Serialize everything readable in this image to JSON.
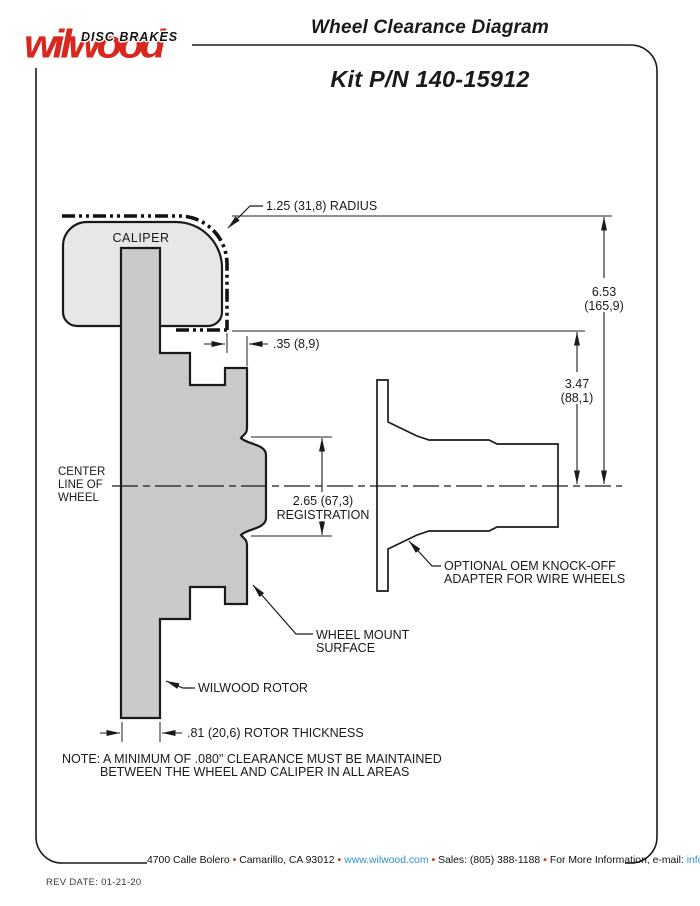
{
  "header": {
    "tagline": "DISC BRAKES",
    "brand": "wilwood",
    "title": "Wheel Clearance Diagram",
    "kit": "Kit P/N 140-15912"
  },
  "diagram": {
    "caliper": "CALIPER",
    "radius": "1.25 (31,8) RADIUS",
    "offset": ".35 (8,9)",
    "height_in": "6.53",
    "height_mm": "(165,9)",
    "hub_in": "3.47",
    "hub_mm": "(88,1)",
    "cl1": "CENTER",
    "cl2": "LINE OF",
    "cl3": "WHEEL",
    "reg_value": "2.65 (67,3)",
    "reg_label": "REGISTRATION",
    "adapter1": "OPTIONAL OEM KNOCK-OFF",
    "adapter2": "ADAPTER FOR WIRE WHEELS",
    "mount1": "WHEEL MOUNT",
    "mount2": "SURFACE",
    "rotor": "WILWOOD ROTOR",
    "thickness": ".81 (20,6) ROTOR THICKNESS",
    "note1": "NOTE: A MINIMUM OF .080\" CLEARANCE MUST BE MAINTAINED",
    "note2": "BETWEEN THE WHEEL AND CALIPER IN ALL AREAS"
  },
  "footer": {
    "address": "4700 Calle Bolero",
    "city": "Camarillo, CA 93012",
    "web": "www.wilwood.com",
    "sales": "Sales: (805) 388-1188",
    "more": "For More Information, e-mail:",
    "email": "info@wilwood.com",
    "sep": "•",
    "rev": "REV DATE:  01-21-20"
  },
  "colors": {
    "brand_red": "#d7271e",
    "link_blue": "#2e93cf",
    "bullet_red": "#c0392b",
    "line": "#1a1a1a",
    "caliper_fill": "#e7e7e7",
    "rotor_fill": "#c9c9cb"
  }
}
